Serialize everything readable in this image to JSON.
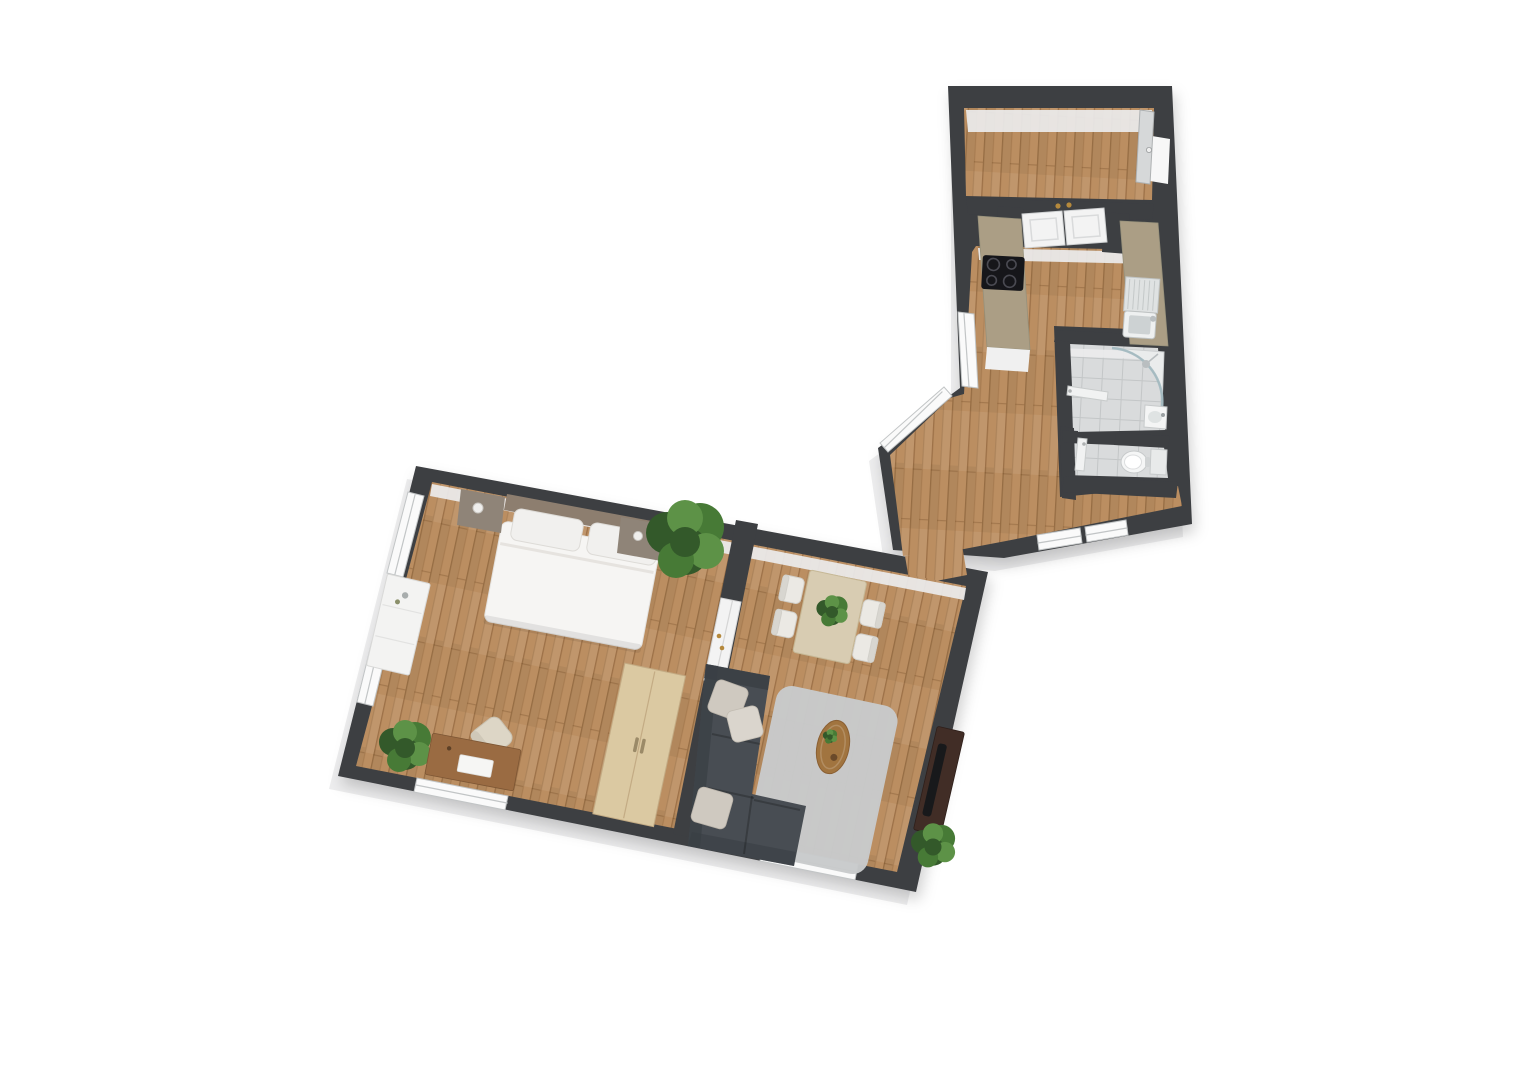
{
  "meta": {
    "scene": "apartment-3d-floor-plan",
    "view": "top-down isometric render",
    "text_visible": "none"
  },
  "rooms": [
    {
      "id": "hallway",
      "label": "Hallway / Entry",
      "floor": "wood",
      "features": [
        "entrance-door",
        "double-interior-door"
      ]
    },
    {
      "id": "kitchen",
      "label": "Kitchen",
      "floor": "wood",
      "features": [
        "cooktop-counter",
        "sink-counter",
        "left-wall-window"
      ]
    },
    {
      "id": "bathroom",
      "label": "Bathroom",
      "floor": "tile",
      "features": [
        "corner-shower",
        "washbasin",
        "door"
      ]
    },
    {
      "id": "wc",
      "label": "WC",
      "floor": "tile",
      "features": [
        "toilet",
        "door"
      ]
    },
    {
      "id": "corridor",
      "label": "Corridor",
      "floor": "wood",
      "features": [
        "two-windows",
        "diagonal-window"
      ]
    },
    {
      "id": "bedroom",
      "label": "Bedroom",
      "floor": "wood",
      "features": [
        "double-bed",
        "two-nightstands",
        "dresser",
        "desk",
        "desk-chair",
        "wardrobe",
        "two-plants",
        "three-windows"
      ]
    },
    {
      "id": "living-room",
      "label": "Living Room",
      "floor": "wood",
      "features": [
        "corner-sofa",
        "area-rug",
        "coffee-table",
        "dining-table",
        "four-chairs",
        "tv-sideboard",
        "plant",
        "window",
        "double-door-to-bedroom"
      ]
    }
  ],
  "colors": {
    "background": "#ffffff",
    "wall": "#3d3f42",
    "plinth": "#ededee",
    "inner_face": "#ececed",
    "wood": "#bb8e61",
    "tile": "#d9dbdc",
    "window_white": "#fafafa",
    "window_frame": "#c2c5c6",
    "door_white": "#f3f3f3",
    "door_frame": "#cfd1d2",
    "door_leaf": "#d6d8d9",
    "handle_gold": "#b5893c",
    "counter": "#ab9e85",
    "cabinet_white": "#f0f0f0",
    "cooktop": "#16161a",
    "burner": "#4a4a52",
    "steel": "#dfe2e2",
    "basin": "#cdd2d3",
    "fixture_white": "#f4f5f5",
    "fixture_stroke": "#c7cacb",
    "glass": "#9db6bd",
    "sofa": "#484d53",
    "sofa_dark": "#393e44",
    "pillow": "#cfc9c0",
    "pillow2": "#dad5cd",
    "rug": "#c8cacb",
    "table_wood": "#a1743f",
    "desk_wood": "#9a6b42",
    "light_wood": "#dbc9a2",
    "dining_wood": "#d8ccb2",
    "chair_white": "#ebe9e4",
    "chair_cream": "#ddd6c6",
    "bed_white": "#f6f5f3",
    "headboard": "#8d7e6f",
    "nightstand": "#8f8478",
    "dresser": "#f3f3f2",
    "tv_stand": "#412d26",
    "tv": "#18191b",
    "plant_dark": "#33592a",
    "plant_mid": "#477a36",
    "plant_light": "#5d9247",
    "paper": "#f6f6f4"
  }
}
